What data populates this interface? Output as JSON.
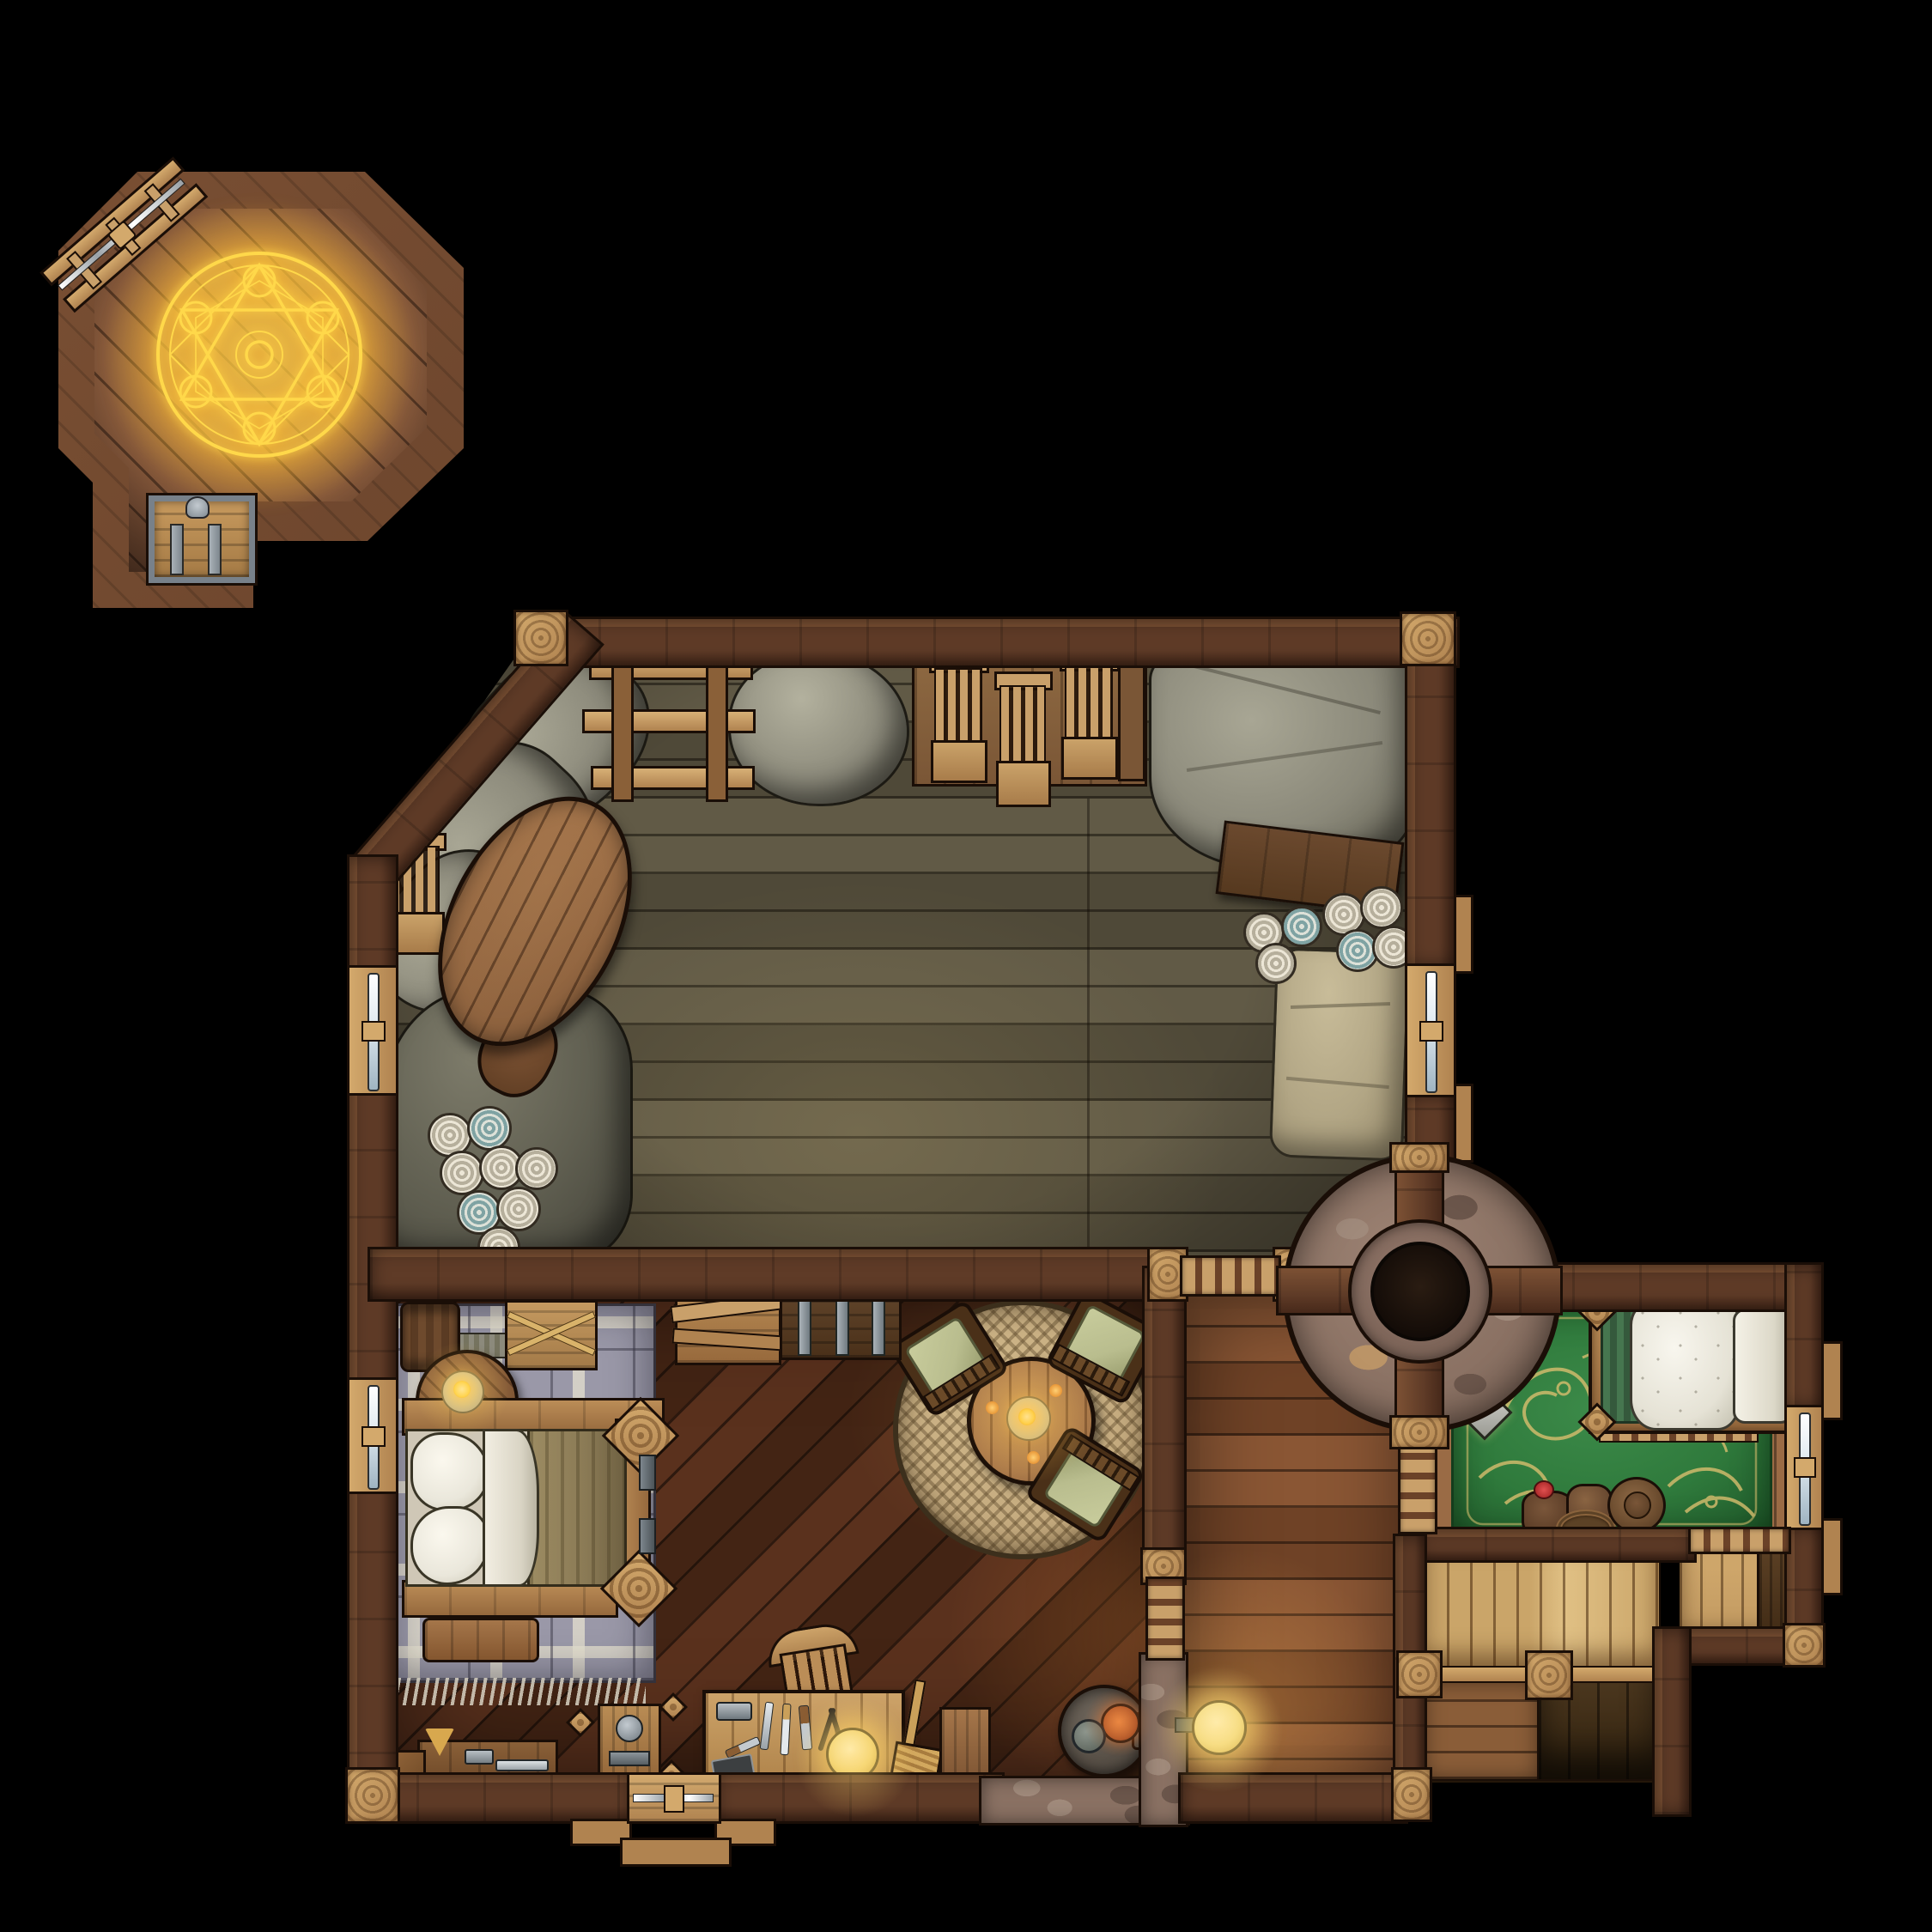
{
  "map": {
    "title": "Top-down fantasy battlemap — carpenter's house upper floor at night",
    "grid": "none",
    "scene": "dark exterior, warm candle-lit interior"
  },
  "palette": {
    "bg": "#000000",
    "outline": "#1a0e07",
    "wall_a": "#5f3b27",
    "wall_b": "#47291a",
    "wall_hi": "#7c5134",
    "post": "#b08350",
    "post_hi": "#d3a96c",
    "stone": "#8a7163",
    "stone_hi": "#a08a7b",
    "stone_lo": "#6b564b",
    "oct_a": "#7c5137",
    "oct_b": "#68422c",
    "attic_a": "#615a46",
    "attic_b": "#4f4938",
    "dine_a": "#5a311d",
    "dine_b": "#432414",
    "dine_hi": "#7c4526",
    "hall_a": "#8a5634",
    "hall_b": "#6f4226",
    "closet": "#c39b62",
    "stair_hi": "#e0c084",
    "stair_mid": "#8a5d38",
    "stair_lo": "#4e3920",
    "sheet": "#8b897a",
    "sheet_hi": "#a8a694",
    "sheet_lo": "#656355",
    "wood_lt": "#c9a06a",
    "wood_md": "#9a6b45",
    "wood_dk": "#6b4228",
    "plaid": "#9a98a8",
    "plaid_line": "#ddd8c8",
    "rug_green": "#2f7a3c",
    "rug_green_dk": "#1f5829",
    "rug_gold": "#d9be6e",
    "rug_round": "#c4aa7e",
    "rug_round_dk": "#9c8159",
    "cushion": "#b9bd8e",
    "pillow": "#eae7db",
    "blanket": "#8a7a55",
    "metal": "#9aa2a8",
    "glass": "#e2ebf1",
    "teal": "#7fa3a3",
    "gold": "#ffd84a",
    "flame": "#ffc14b",
    "furnace": "#564e45"
  },
  "rooms": {
    "summoning": {
      "label": "Octagonal summoning chamber with glowing golden magic circle, chest alcove, ladder outside"
    },
    "attic": {
      "label": "Large storage attic: sheet-covered furniture, stacked chairs, bench with fabric bolts, bedroll"
    },
    "bedroom": {
      "label": "Bedroom: double bed on plaid rug, round nightstand with candle, barrel, crates, banded chest"
    },
    "dining": {
      "label": "Dining nook: round table with candles and three cushioned chairs on a woven round rug"
    },
    "workshop": {
      "label": "Workbench corner: tool bench, clamp press, stove with pipe, broom, door to outside"
    },
    "hallway": {
      "label": "Hallway with wall lamp beside central round stone chimney"
    },
    "guest": {
      "label": "Guest room: green-gold patterned carpet, bed with fur cover, lantern, travel pile with hat"
    },
    "stairs": {
      "label": "Stairwell descending with carved newel posts"
    },
    "closet": {
      "label": "Small plank closet with crate"
    }
  },
  "features": {
    "magic_circle": "six-pointed golden summoning circle with orb nodes",
    "fireplace": "round central stone chimney with crossing timber beams and open flue",
    "lights": [
      "magic circle glow",
      "nightstand candle",
      "dining table candles",
      "workbench lamp",
      "hallway wall lamp",
      "stove embers"
    ]
  }
}
